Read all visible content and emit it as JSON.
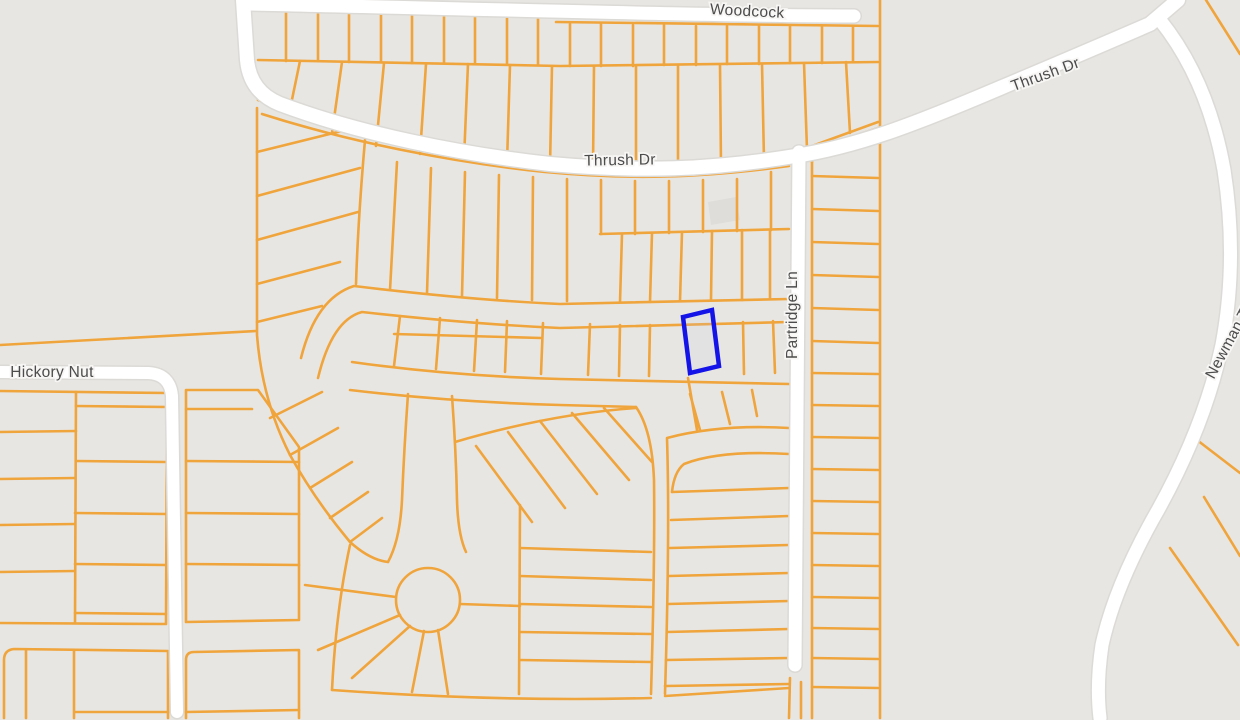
{
  "map": {
    "labels": {
      "woodcock": {
        "text": "Woodcock"
      },
      "thrush_main": {
        "text": "Thrush Dr"
      },
      "thrush_ne": {
        "text": "Thrush Dr"
      },
      "partridge": {
        "text": "Partridge Ln"
      },
      "hickory_nut": {
        "text": "Hickory Nut"
      },
      "newman": {
        "text": "Newman Trl"
      }
    },
    "highlighted_parcel": {
      "description": "selected-lot-outline"
    },
    "colors": {
      "background": "#e8e6e2",
      "lot_line": "#f0a43c",
      "road": "#ffffff",
      "road_casing": "#dcdad6",
      "label": "#4c4c4c",
      "label_halo": "#f7f6f4",
      "parcel_stroke": "#1414e8",
      "parcel_fill": "#c9cce9",
      "building": "#dfddd9"
    }
  }
}
